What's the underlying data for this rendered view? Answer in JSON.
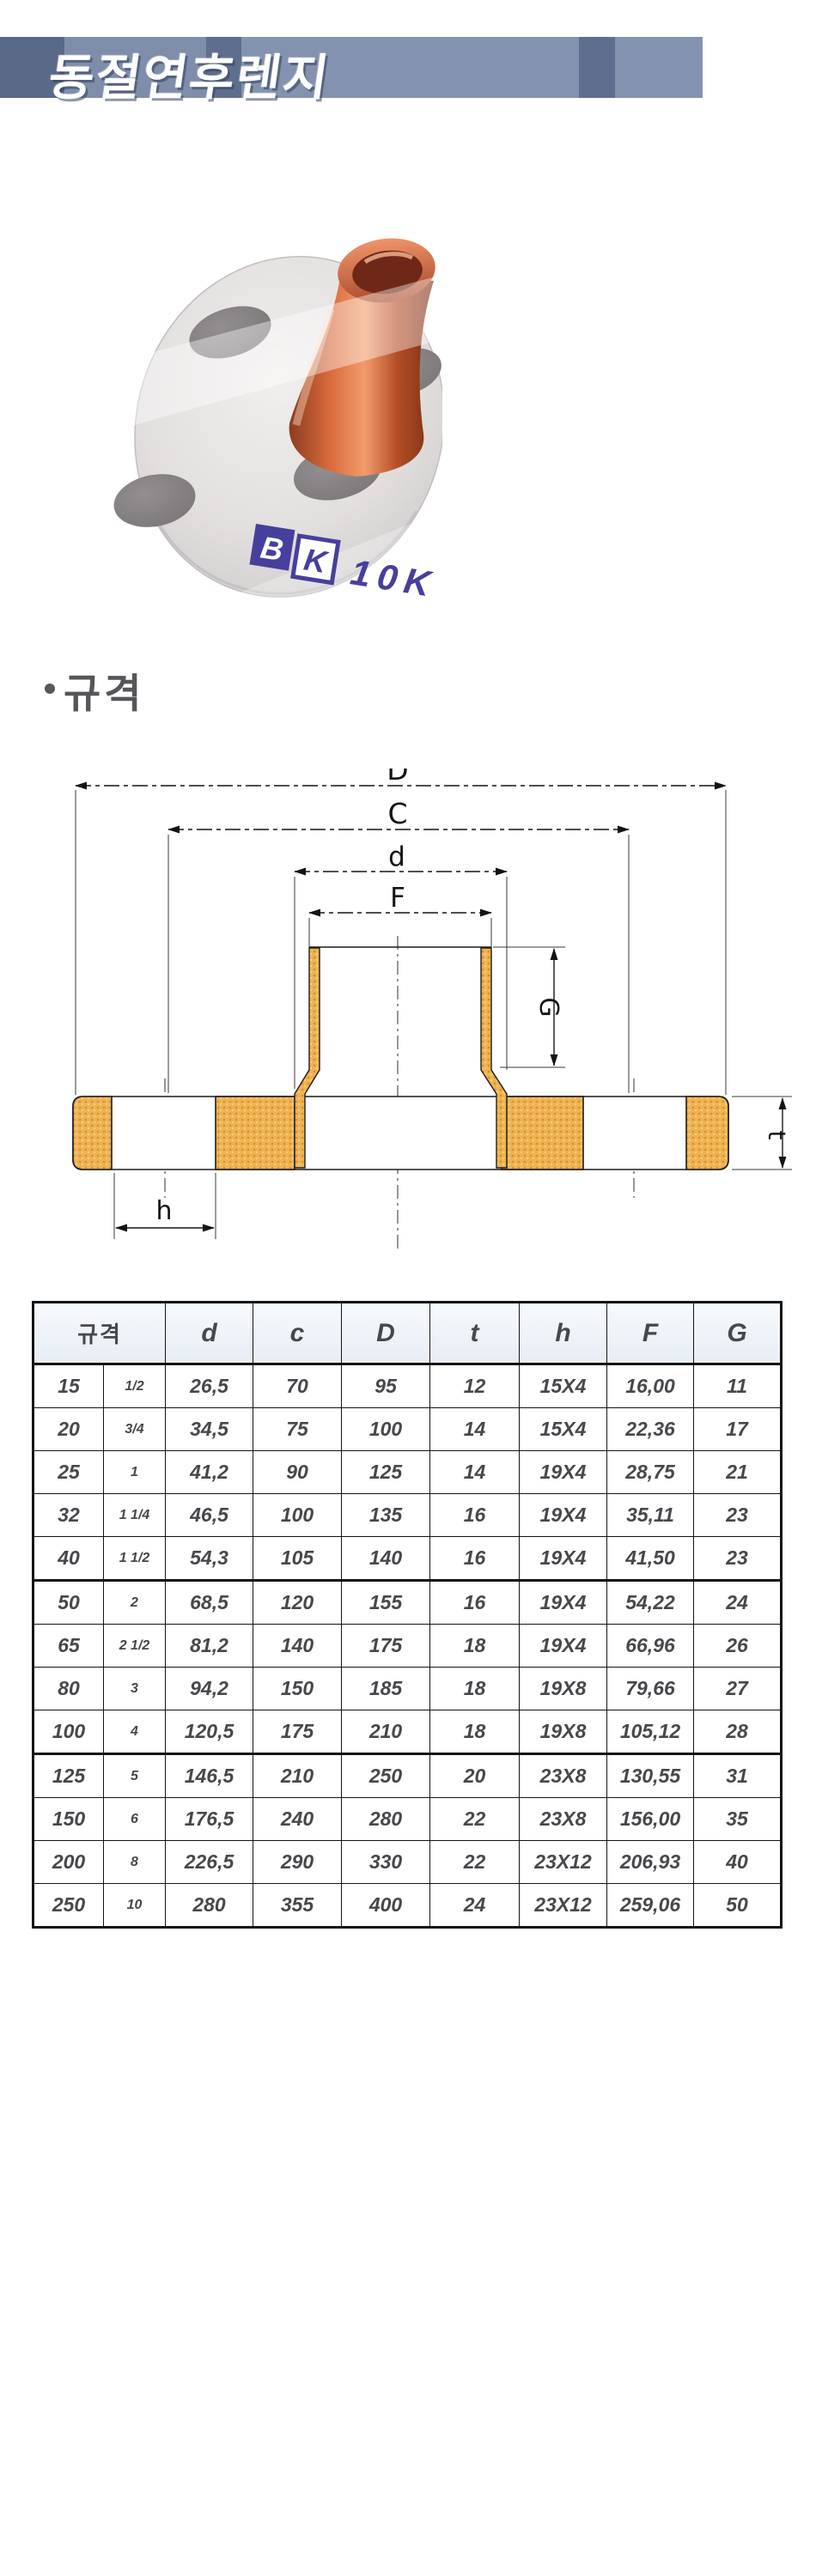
{
  "page": {
    "title": "동절연후렌지"
  },
  "section": {
    "title": "규격"
  },
  "photo": {
    "brand_left": "B",
    "brand_right": "K",
    "stamp": "10K 20"
  },
  "diagram": {
    "labels": {
      "D": "D",
      "C": "C",
      "d": "d",
      "F": "F",
      "G": "G",
      "t": "t",
      "h": "h"
    }
  },
  "table": {
    "header": {
      "size": "규격",
      "cols": [
        "d",
        "c",
        "D",
        "t",
        "h",
        "F",
        "G"
      ]
    },
    "rows": [
      [
        "15",
        "1/2",
        "26,5",
        "70",
        "95",
        "12",
        "15X4",
        "16,00",
        "11"
      ],
      [
        "20",
        "3/4",
        "34,5",
        "75",
        "100",
        "14",
        "15X4",
        "22,36",
        "17"
      ],
      [
        "25",
        "1",
        "41,2",
        "90",
        "125",
        "14",
        "19X4",
        "28,75",
        "21"
      ],
      [
        "32",
        "1 1/4",
        "46,5",
        "100",
        "135",
        "16",
        "19X4",
        "35,11",
        "23"
      ],
      [
        "40",
        "1 1/2",
        "54,3",
        "105",
        "140",
        "16",
        "19X4",
        "41,50",
        "23"
      ],
      [
        "50",
        "2",
        "68,5",
        "120",
        "155",
        "16",
        "19X4",
        "54,22",
        "24"
      ],
      [
        "65",
        "2 1/2",
        "81,2",
        "140",
        "175",
        "18",
        "19X4",
        "66,96",
        "26"
      ],
      [
        "80",
        "3",
        "94,2",
        "150",
        "185",
        "18",
        "19X8",
        "79,66",
        "27"
      ],
      [
        "100",
        "4",
        "120,5",
        "175",
        "210",
        "18",
        "19X8",
        "105,12",
        "28"
      ],
      [
        "125",
        "5",
        "146,5",
        "210",
        "250",
        "20",
        "23X8",
        "130,55",
        "31"
      ],
      [
        "150",
        "6",
        "176,5",
        "240",
        "280",
        "22",
        "23X8",
        "156,00",
        "35"
      ],
      [
        "200",
        "8",
        "226,5",
        "290",
        "330",
        "22",
        "23X12",
        "206,93",
        "40"
      ],
      [
        "250",
        "10",
        "280",
        "355",
        "400",
        "24",
        "23X12",
        "259,06",
        "50"
      ]
    ],
    "group_breaks": [
      4,
      8
    ]
  },
  "colors": {
    "titlebar_dark": "#5a6988",
    "titlebar_light": "#8392ae",
    "flange_gold": "#eeb04a",
    "stamp_purple": "#473f9c",
    "header_tint": "#eef3f8"
  }
}
